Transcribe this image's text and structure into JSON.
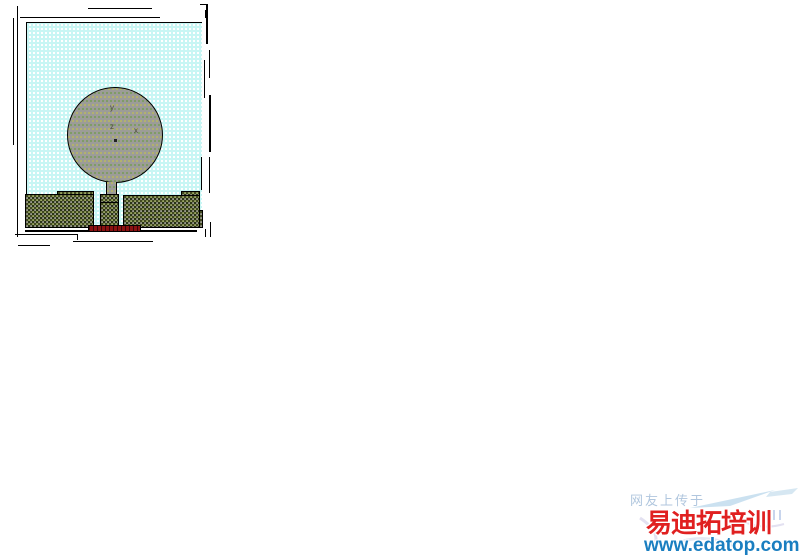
{
  "figure": {
    "description": "circular-monopole-antenna-model",
    "axis_labels": {
      "x": "x",
      "y": "y",
      "z": "z"
    },
    "colors": {
      "substrate_cyan": "#c8f6f4",
      "patch_gray": "#9c9c98",
      "ground_gray": "#9a9a8e",
      "port_red": "#8b1212",
      "outline_black": "#000000"
    }
  },
  "watermark": {
    "upload_note": "网友上传于",
    "brand": "易迪拓培训",
    "url": "www.edatop.com",
    "brand_color": "#e02020",
    "url_color": "#1a7ec0",
    "note_color": "#9db9d6"
  }
}
